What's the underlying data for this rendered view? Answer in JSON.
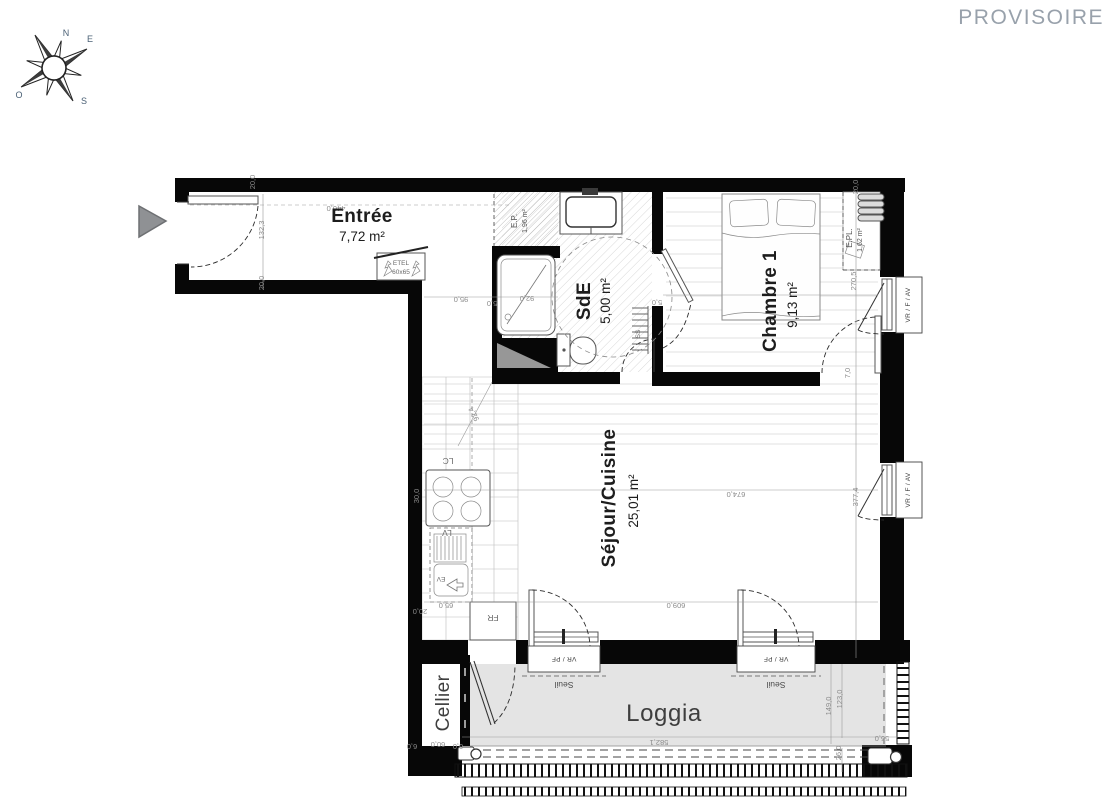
{
  "page": {
    "status_label": "PROVISOIRE"
  },
  "compass": {
    "n": "N",
    "e": "E",
    "s": "S",
    "o": "O"
  },
  "rooms": [
    {
      "name": "entree",
      "label": "Entrée",
      "area": "7,72 m²"
    },
    {
      "name": "sde",
      "label": "SdE",
      "area": "5,00 m²"
    },
    {
      "name": "chambre1",
      "label": "Chambre 1",
      "area": "9,13 m²"
    },
    {
      "name": "sejour",
      "label": "Séjour/Cuisine",
      "area": "25,01 m²"
    },
    {
      "name": "loggia",
      "label": "Loggia"
    },
    {
      "name": "cellier",
      "label": "Cellier"
    }
  ],
  "closets": [
    {
      "label": "E.P.",
      "area": "1,96 m²"
    },
    {
      "label": "E.PL.",
      "area": "1,62 m²"
    }
  ],
  "fixtures": {
    "etel": "ETEL",
    "etel_size": "60x65",
    "lc": "LC",
    "lv": "LV",
    "ev": "EV",
    "fr": "FR",
    "ss": "SS"
  },
  "windows": {
    "right_label": "VR / F / AV",
    "bottom_label": "VR / PF",
    "sill": "Seuil"
  },
  "plan": {
    "dimensions": [
      {
        "text": "20,0",
        "x": 255,
        "y": 182,
        "rot": -90
      },
      {
        "text": "440,0",
        "x": 336,
        "y": 206,
        "rot": 180
      },
      {
        "text": "132,3",
        "x": 264,
        "y": 230,
        "rot": -90
      },
      {
        "text": "20,0",
        "x": 264,
        "y": 283,
        "rot": -90
      },
      {
        "text": "95,0",
        "x": 461,
        "y": 297,
        "rot": 180
      },
      {
        "text": "5,0",
        "x": 492,
        "y": 301,
        "rot": 180
      },
      {
        "text": "92,0",
        "x": 527,
        "y": 296,
        "rot": 180
      },
      {
        "text": "92,4",
        "x": 476,
        "y": 413,
        "rot": 242
      },
      {
        "text": "674,0",
        "x": 736,
        "y": 492,
        "rot": 180
      },
      {
        "text": "609,0",
        "x": 676,
        "y": 603,
        "rot": 180
      },
      {
        "text": "30,0",
        "x": 419,
        "y": 496,
        "rot": -90
      },
      {
        "text": "65,0",
        "x": 446,
        "y": 603,
        "rot": 180
      },
      {
        "text": "20,0",
        "x": 420,
        "y": 609,
        "rot": 180
      },
      {
        "text": "20,0",
        "x": 858,
        "y": 187,
        "rot": -90
      },
      {
        "text": "270,5",
        "x": 856,
        "y": 281,
        "rot": -90
      },
      {
        "text": "7,0",
        "x": 850,
        "y": 373,
        "rot": -90
      },
      {
        "text": "377,4",
        "x": 858,
        "y": 497,
        "rot": -90
      },
      {
        "text": "5,0",
        "x": 657,
        "y": 300,
        "rot": 180
      },
      {
        "text": "60,0",
        "x": 438,
        "y": 742,
        "rot": 180
      },
      {
        "text": "6,0",
        "x": 412,
        "y": 744,
        "rot": 180
      },
      {
        "text": "6,0",
        "x": 458,
        "y": 744,
        "rot": 180
      },
      {
        "text": "582,1",
        "x": 659,
        "y": 740,
        "rot": 180
      },
      {
        "text": "56,0",
        "x": 882,
        "y": 736,
        "rot": 180
      },
      {
        "text": "149,0",
        "x": 831,
        "y": 706,
        "rot": -90
      },
      {
        "text": "123,0",
        "x": 842,
        "y": 699,
        "rot": -90
      },
      {
        "text": "26,0",
        "x": 841,
        "y": 753,
        "rot": -90
      }
    ]
  }
}
